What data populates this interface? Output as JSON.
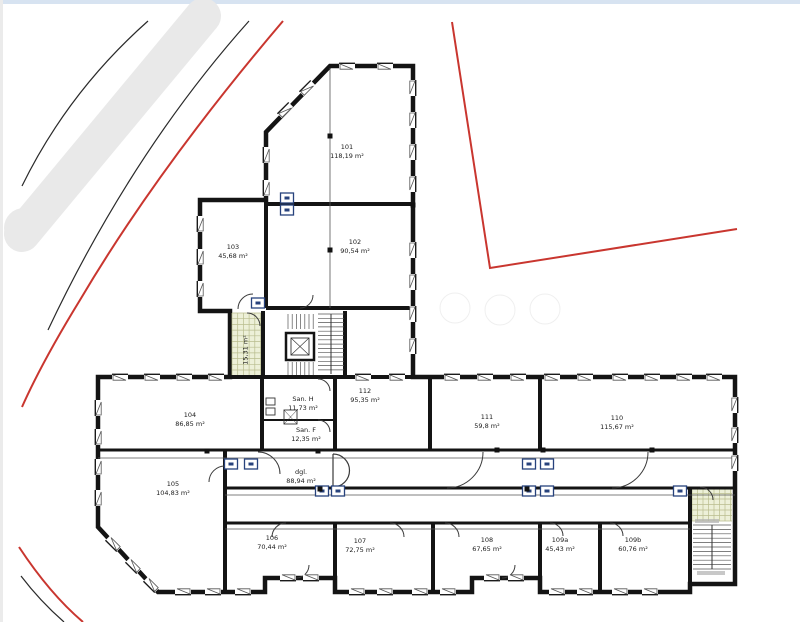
{
  "plan_title": "Floor plan with site boundary",
  "colors": {
    "wall": "#141414",
    "thin_line": "#444444",
    "boundary_red": "#c9362f",
    "road_band_gray": "#e9e9e9",
    "tile_fill": "#edf0d8",
    "tile_grid": "#b9bd8e",
    "symbol_box_blue": "#27427c",
    "top_strip_blue": "#d7e3f1",
    "left_strip_gray": "#ebebeb"
  },
  "rooms": [
    {
      "number": "101",
      "area": "118,19 m²"
    },
    {
      "number": "102",
      "area": "90,54 m²"
    },
    {
      "number": "103",
      "area": "45,68 m²"
    },
    {
      "number": "104",
      "area": "86,85 m²"
    },
    {
      "number": "105",
      "area": "104,83 m²"
    },
    {
      "number": "106",
      "area": "70,44 m²"
    },
    {
      "number": "107",
      "area": "72,75 m²"
    },
    {
      "number": "108",
      "area": "67,65 m²"
    },
    {
      "number": "109a",
      "area": "45,43 m²"
    },
    {
      "number": "109b",
      "area": "60,76 m²"
    },
    {
      "number": "110",
      "area": "115,67 m²"
    },
    {
      "number": "111",
      "area": "59,8 m²"
    },
    {
      "number": "112",
      "area": "95,35 m²"
    },
    {
      "number": "San. H",
      "area": "11,73 m²"
    },
    {
      "number": "San. F",
      "area": "12,35 m²"
    },
    {
      "number": "dgl.",
      "area": "88,94 m²"
    },
    {
      "number": "",
      "area": "15,31 m²"
    }
  ]
}
